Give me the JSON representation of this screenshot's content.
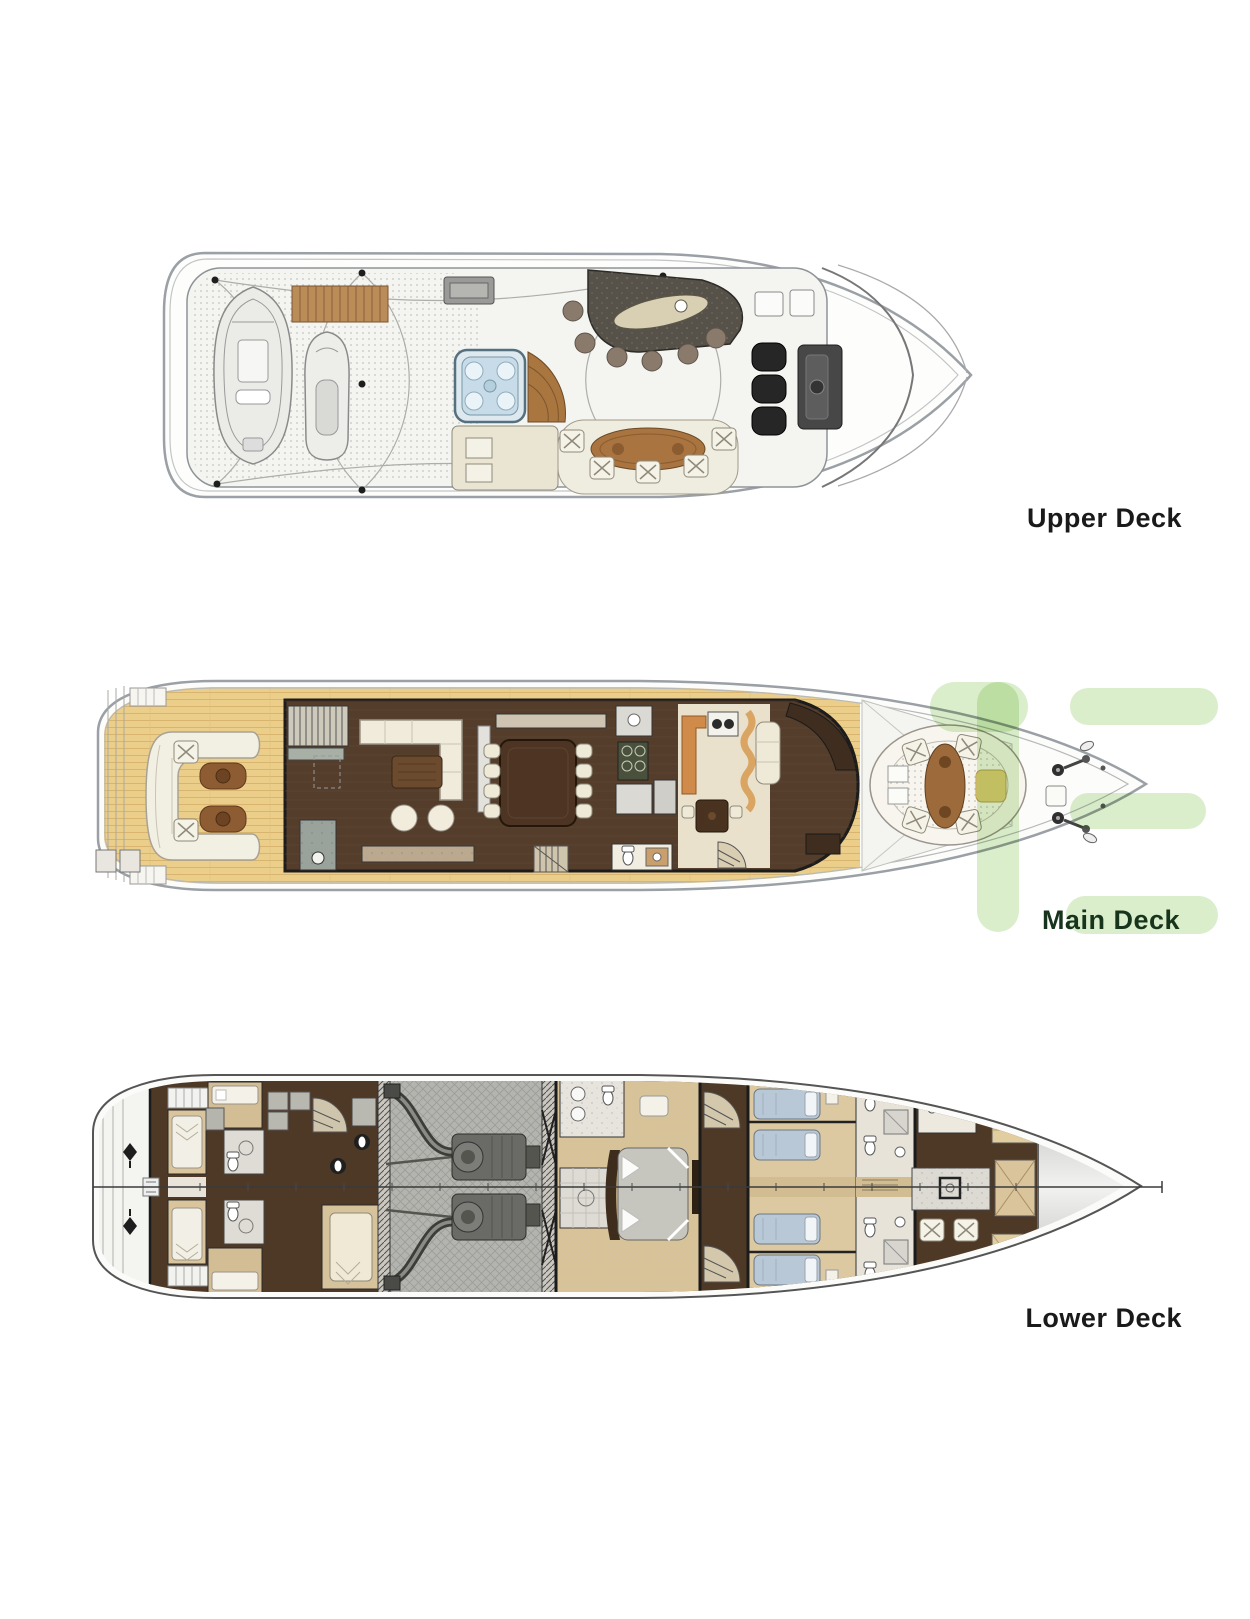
{
  "page": {
    "title": "Yacht deck plans",
    "width": 1250,
    "height": 1619,
    "background": "#ffffff"
  },
  "decks": [
    {
      "id": "upper-deck",
      "label": "Upper Deck",
      "drawn_elements": [
        "tender-icon",
        "jet-ski-icon",
        "gangway-icon",
        "jacuzzi-icon",
        "bar-counter-icon",
        "bar-stools-icon",
        "dining-table-icon",
        "helm-chairs-icon",
        "helm-console-icon",
        "sun-pad-area",
        "windshield"
      ]
    },
    {
      "id": "main-deck",
      "label": "Main Deck",
      "drawn_elements": [
        "swim-steps",
        "aft-deck-sofa-icon",
        "aft-tables-icon",
        "salon-sofa-icon",
        "coffee-table-icon",
        "dining-table-icon",
        "galley-stove-icon",
        "breakfast-banquette-icon",
        "day-head-icon",
        "stairs-icon",
        "helm-console-icon",
        "bow-seating-icon",
        "windlass-icon",
        "teak-deck"
      ]
    },
    {
      "id": "lower-deck",
      "label": "Lower Deck",
      "drawn_elements": [
        "swim-platform",
        "crew-bunks-icon",
        "engine-room",
        "engines-icon",
        "master-bed-icon",
        "shower-icon",
        "guest-beds-icon",
        "toilet-icons",
        "vip-bathroom-icons",
        "bow-locker",
        "centerline"
      ]
    }
  ],
  "colors": {
    "label": "#1a1a1a",
    "label_main": "#17351d",
    "watermark": "#d9edca",
    "hull_outline": "#9aa0a5",
    "teak_deck": "#ecce8b",
    "salon_floor": "#543d2b",
    "engine_room_floor": "#b3b3af",
    "cabin_floor": "#dcc9a2",
    "bedding_blue": "#b9c8d6",
    "furniture_cream": "#f2efe3",
    "furniture_wood": "#9c6a3b",
    "jacuzzi_blue": "#c7dce8",
    "bow_locker_gray": "#bcbcbb"
  },
  "watermark": {
    "color": "#d9edca",
    "shape": "logo-bars"
  }
}
